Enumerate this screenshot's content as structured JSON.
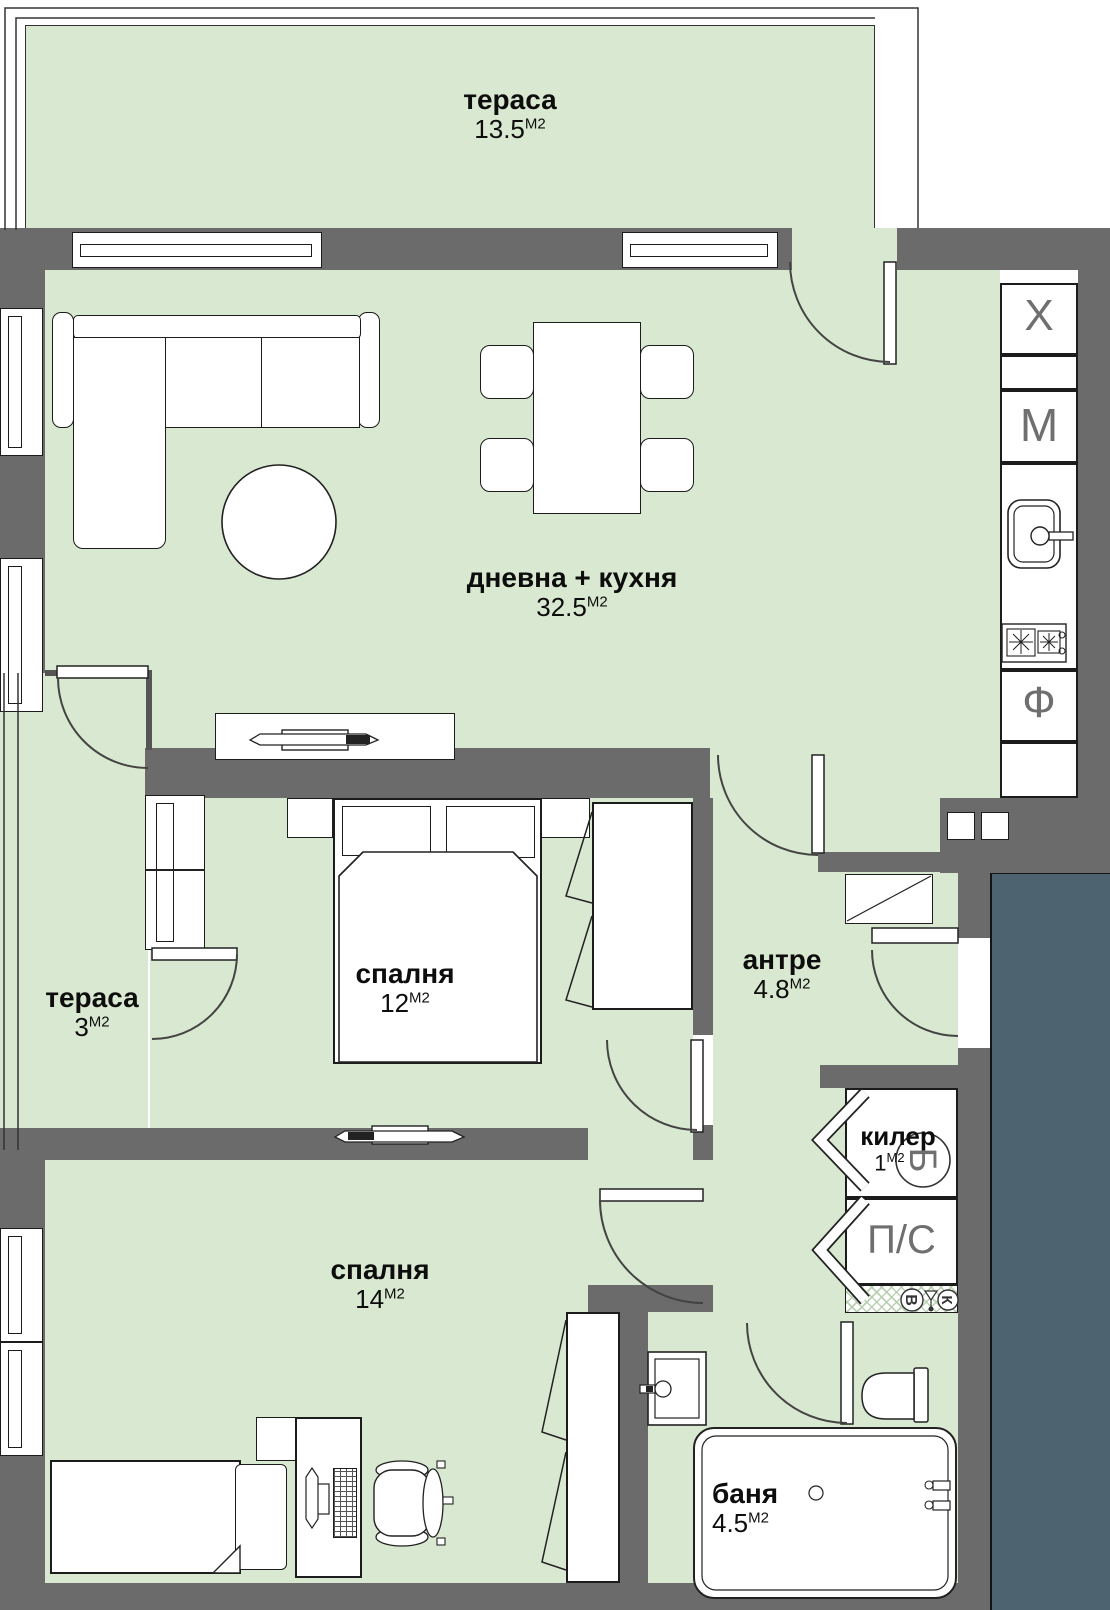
{
  "floor_plan": {
    "rooms": {
      "terrace_top": {
        "name": "тераса",
        "area": "13.5",
        "unit": "М2"
      },
      "living_kitchen": {
        "name": "дневна + кухня",
        "area": "32.5",
        "unit": "М2"
      },
      "terrace_left": {
        "name": "тераса",
        "area": "3",
        "unit": "М2"
      },
      "bedroom_1": {
        "name": "спалня",
        "area": "12",
        "unit": "М2"
      },
      "hallway": {
        "name": "антре",
        "area": "4.8",
        "unit": "М2"
      },
      "closet": {
        "name": "килер",
        "area": "1",
        "unit": "М2"
      },
      "bedroom_2": {
        "name": "спалня",
        "area": "14",
        "unit": "М2"
      },
      "bathroom": {
        "name": "баня",
        "area": "4.5",
        "unit": "М2"
      }
    },
    "kitchen_column": {
      "letters": [
        "Х",
        "М",
        "Ф"
      ]
    },
    "utility": {
      "boiler_label": "Б",
      "washer_dryer_label": "П/С",
      "water_label": "В",
      "sewer_label": "К"
    },
    "colors": {
      "floor_green": "#d9e8d0",
      "wall_gray": "#6b6b6b",
      "adjacent_unit": "#4d636f"
    }
  }
}
